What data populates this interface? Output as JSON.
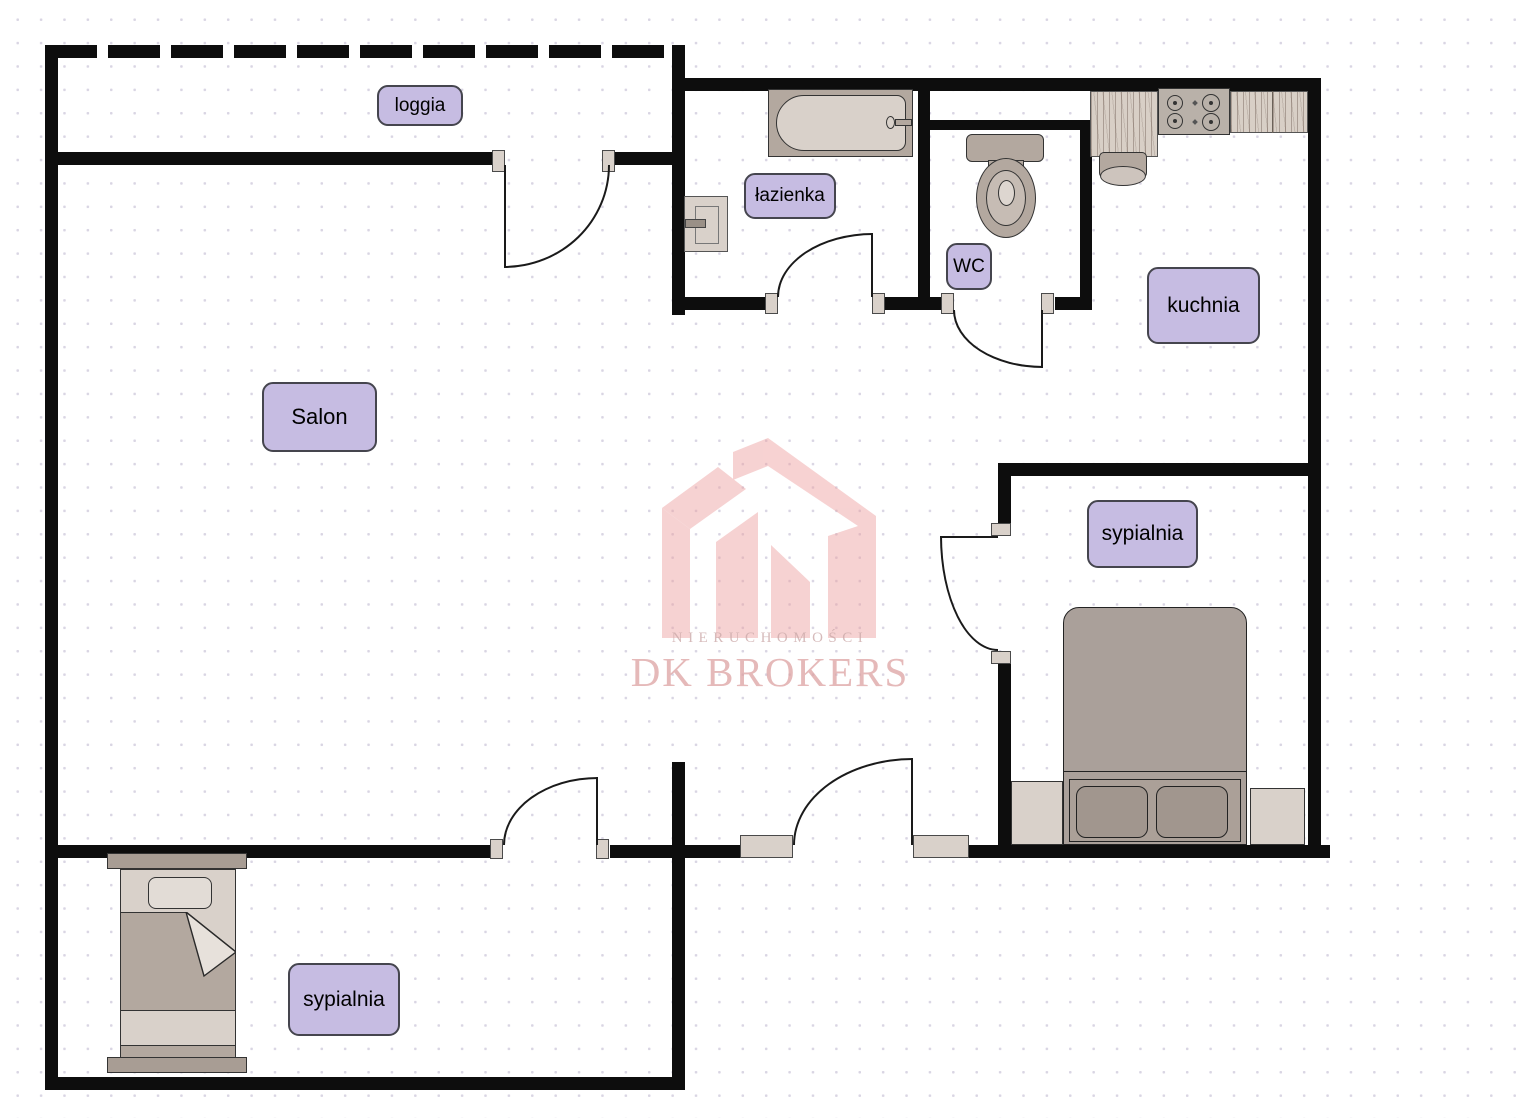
{
  "rooms": {
    "loggia": {
      "label": "loggia"
    },
    "salon": {
      "label": "Salon"
    },
    "lazienka": {
      "label": "łazienka"
    },
    "wc": {
      "label": "WC"
    },
    "kuchnia": {
      "label": "kuchnia"
    },
    "sypialnia_right": {
      "label": "sypialnia"
    },
    "sypialnia_bottom": {
      "label": "sypialnia"
    }
  },
  "watermark": {
    "brand_line1": "NIERUCHOMOŚCI",
    "brand_line2": "DK BROKERS"
  },
  "colors": {
    "wall": "#0d0d0d",
    "label-fill": "#c6bce2",
    "label-border": "#45454e",
    "fix-light": "#d9d1ca",
    "fix-mid": "#b3a89f",
    "fix-dark": "#a89d94",
    "wood": "#d8cfc6",
    "wm-pink": "#ec9e9e",
    "wm-text1": "#c49c9c",
    "wm-text2": "#dc9f9f",
    "dot": "#d9d5e3"
  }
}
